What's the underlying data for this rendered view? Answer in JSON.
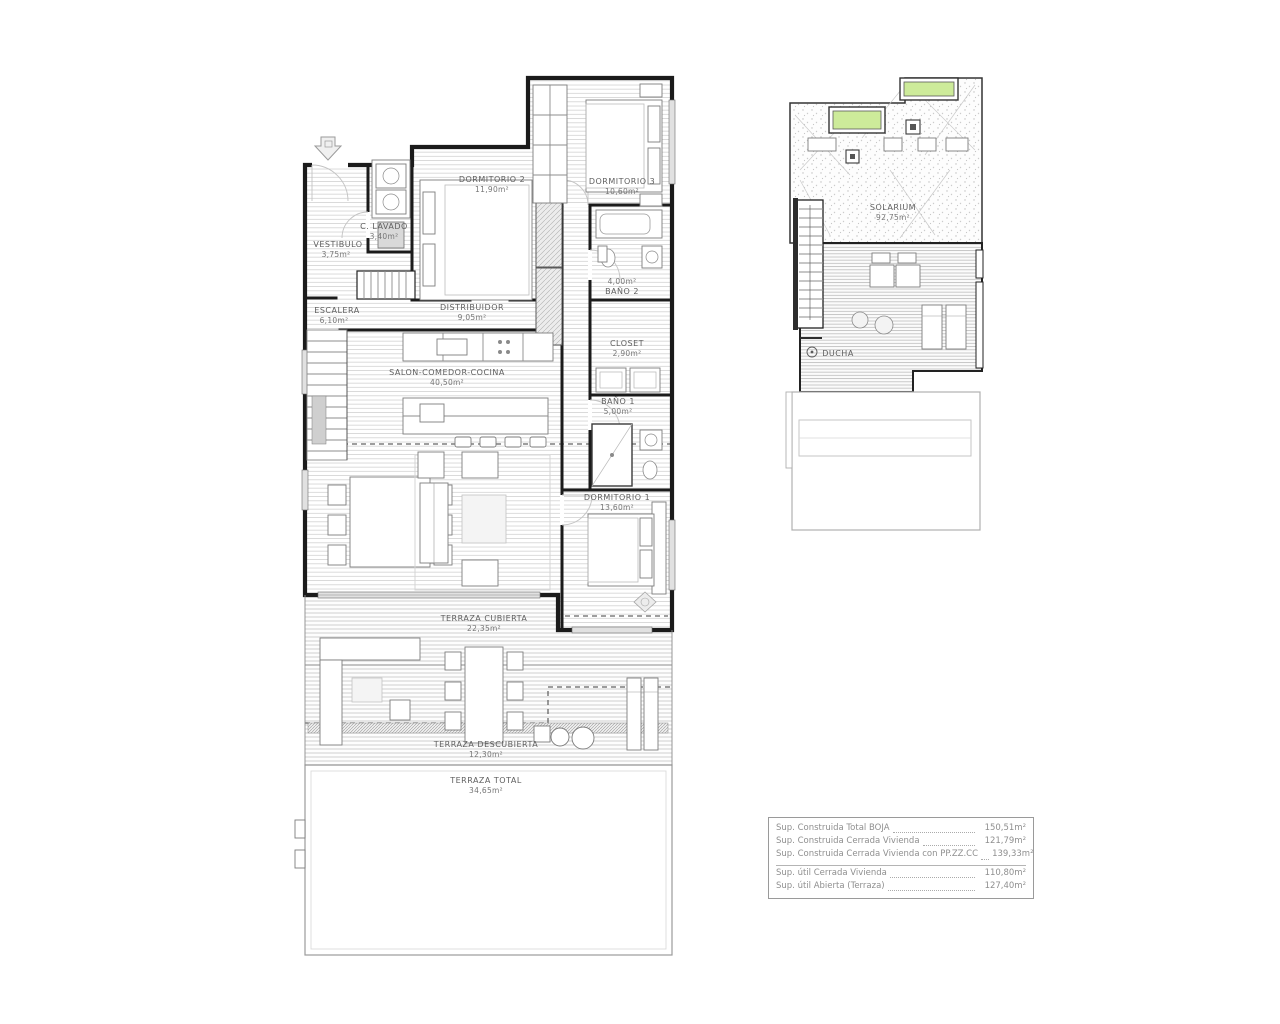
{
  "main_plan": {
    "rooms": [
      {
        "name": "VESTIBULO",
        "area": "3,75m²"
      },
      {
        "name": "C. LAVADO",
        "area": "3,40m²"
      },
      {
        "name": "DORMITORIO 2",
        "area": "11,90m²"
      },
      {
        "name": "DORMITORIO 3",
        "area": "10,60m²"
      },
      {
        "name": "ESCALERA",
        "area": "6,10m²"
      },
      {
        "name": "DISTRIBUIDOR",
        "area": "9,05m²"
      },
      {
        "name": "BAÑO 2",
        "area": "4,00m²"
      },
      {
        "name": "CLOSET",
        "area": "2,90m²"
      },
      {
        "name": "SALON-COMEDOR-COCINA",
        "area": "40,50m²"
      },
      {
        "name": "BAÑO 1",
        "area": "5,00m²"
      },
      {
        "name": "DORMITORIO 1",
        "area": "13,60m²"
      },
      {
        "name": "TERRAZA CUBIERTA",
        "area": "22,35m²"
      },
      {
        "name": "TERRAZA DESCUBIERTA",
        "area": "12,30m²"
      },
      {
        "name": "TERRAZA TOTAL",
        "area": "34,65m²"
      }
    ]
  },
  "roof_plan": {
    "rooms": [
      {
        "name": "SOLARIUM",
        "area": "92,75m²"
      },
      {
        "name": "DUCHA",
        "area": ""
      }
    ]
  },
  "summary_table": {
    "rows": [
      {
        "label": "Sup. Construida Total BOJA",
        "value": "150,51m²"
      },
      {
        "label": "Sup. Construida Cerrada Vivienda",
        "value": "121,79m²"
      },
      {
        "label": "Sup. Construida Cerrada Vivienda con PP.ZZ.CC",
        "value": "139,33m²"
      },
      {
        "label": "Sup. útil Cerrada Vivienda",
        "value": "110,80m²"
      },
      {
        "label": "Sup. útil Abierta (Terraza)",
        "value": "127,40m²"
      }
    ]
  },
  "colors": {
    "wall": "#1b1b1b",
    "label_text": "#5f5f5f",
    "hatch_line": "#c9c9c9",
    "skylight_green": "#cdeb9a",
    "table_text": "#8f8f8f"
  }
}
